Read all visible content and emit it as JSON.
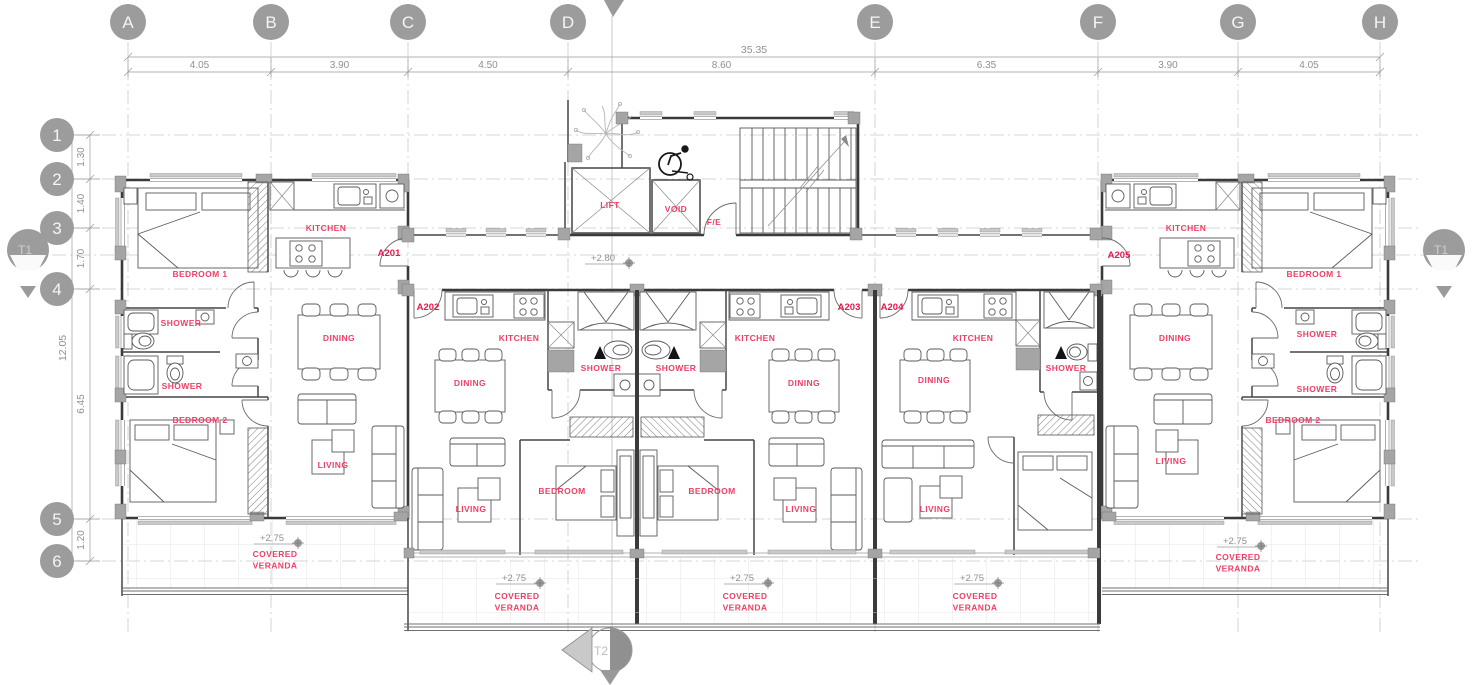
{
  "drawing_type": "apartment-building-floor-plan",
  "grid": {
    "columns": [
      {
        "label": "A",
        "x": 128
      },
      {
        "label": "B",
        "x": 271
      },
      {
        "label": "C",
        "x": 408
      },
      {
        "label": "D",
        "x": 568
      },
      {
        "label": "E",
        "x": 875
      },
      {
        "label": "F",
        "x": 1098
      },
      {
        "label": "G",
        "x": 1238
      },
      {
        "label": "H",
        "x": 1380
      }
    ],
    "rows": [
      {
        "label": "1",
        "y": 135
      },
      {
        "label": "2",
        "y": 179
      },
      {
        "label": "3",
        "y": 228
      },
      {
        "label": "4",
        "y": 289
      },
      {
        "label": "5",
        "y": 519
      },
      {
        "label": "6",
        "y": 561
      }
    ],
    "top_dims": {
      "overall": "35.35",
      "segments": [
        "4.05",
        "3.90",
        "4.50",
        "8.60",
        "6.35",
        "3.90",
        "4.05"
      ]
    },
    "left_dims": {
      "overall": "12.05",
      "segments": [
        "1.30",
        "1.40",
        "1.70",
        "6.45",
        "1.20"
      ]
    }
  },
  "section_markers": {
    "left": "T1",
    "right": "T1",
    "bottom": "T2"
  },
  "apartment_labels": [
    {
      "text": "A201",
      "x": 389,
      "y": 256
    },
    {
      "text": "A202",
      "x": 428,
      "y": 310
    },
    {
      "text": "A203",
      "x": 849,
      "y": 310
    },
    {
      "text": "A204",
      "x": 892,
      "y": 310
    },
    {
      "text": "A205",
      "x": 1119,
      "y": 258
    }
  ],
  "room_labels": [
    {
      "text": "BEDROOM 1",
      "x": 200,
      "y": 277
    },
    {
      "text": "KITCHEN",
      "x": 326,
      "y": 231
    },
    {
      "text": "SHOWER",
      "x": 181,
      "y": 326
    },
    {
      "text": "SHOWER",
      "x": 182,
      "y": 389
    },
    {
      "text": "DINING",
      "x": 339,
      "y": 341
    },
    {
      "text": "BEDROOM 2",
      "x": 200,
      "y": 423
    },
    {
      "text": "LIVING",
      "x": 333,
      "y": 468
    },
    {
      "text": "LIFT",
      "x": 610,
      "y": 208
    },
    {
      "text": "VOID",
      "x": 676,
      "y": 212
    },
    {
      "text": "F/E",
      "x": 714,
      "y": 225
    },
    {
      "text": "KITCHEN",
      "x": 519,
      "y": 341
    },
    {
      "text": "SHOWER",
      "x": 601,
      "y": 371
    },
    {
      "text": "DINING",
      "x": 470,
      "y": 386
    },
    {
      "text": "BEDROOM",
      "x": 562,
      "y": 494
    },
    {
      "text": "LIVING",
      "x": 471,
      "y": 512
    },
    {
      "text": "KITCHEN",
      "x": 755,
      "y": 341
    },
    {
      "text": "SHOWER",
      "x": 676,
      "y": 371
    },
    {
      "text": "DINING",
      "x": 804,
      "y": 386
    },
    {
      "text": "BEDROOM",
      "x": 712,
      "y": 494
    },
    {
      "text": "LIVING",
      "x": 801,
      "y": 512
    },
    {
      "text": "KITCHEN",
      "x": 973,
      "y": 341
    },
    {
      "text": "SHOWER",
      "x": 1066,
      "y": 371
    },
    {
      "text": "DINING",
      "x": 934,
      "y": 383
    },
    {
      "text": "LIVING",
      "x": 935,
      "y": 512
    },
    {
      "text": "KITCHEN",
      "x": 1186,
      "y": 231
    },
    {
      "text": "BEDROOM 1",
      "x": 1314,
      "y": 277
    },
    {
      "text": "DINING",
      "x": 1175,
      "y": 341
    },
    {
      "text": "SHOWER",
      "x": 1317,
      "y": 337
    },
    {
      "text": "SHOWER",
      "x": 1317,
      "y": 392
    },
    {
      "text": "BEDROOM 2",
      "x": 1293,
      "y": 423
    },
    {
      "text": "LIVING",
      "x": 1171,
      "y": 464
    }
  ],
  "level_labels": [
    {
      "text": "+2.80",
      "x": 603,
      "y": 261
    },
    {
      "text": "+2.75",
      "x": 272,
      "y": 541
    },
    {
      "text": "+2.75",
      "x": 514,
      "y": 581
    },
    {
      "text": "+2.75",
      "x": 742,
      "y": 581
    },
    {
      "text": "+2.75",
      "x": 972,
      "y": 581
    },
    {
      "text": "+2.75",
      "x": 1235,
      "y": 544
    }
  ],
  "veranda_labels": [
    {
      "lines": [
        "COVERED",
        "VERANDA"
      ],
      "x": 275,
      "y": 557
    },
    {
      "lines": [
        "COVERED",
        "VERANDA"
      ],
      "x": 517,
      "y": 599
    },
    {
      "lines": [
        "COVERED",
        "VERANDA"
      ],
      "x": 745,
      "y": 599
    },
    {
      "lines": [
        "COVERED",
        "VERANDA"
      ],
      "x": 975,
      "y": 599
    },
    {
      "lines": [
        "COVERED",
        "VERANDA"
      ],
      "x": 1238,
      "y": 560
    }
  ],
  "colors": {
    "label_red": "#ee4066",
    "apartment_red": "#e3184b",
    "bubble": "#9c9c9c",
    "bubble_text": "#f5f5f5",
    "dim_text": "#909090",
    "wall": "#3a3a3a",
    "grid_line": "#c9c9c9",
    "warning_black": "#141414"
  }
}
